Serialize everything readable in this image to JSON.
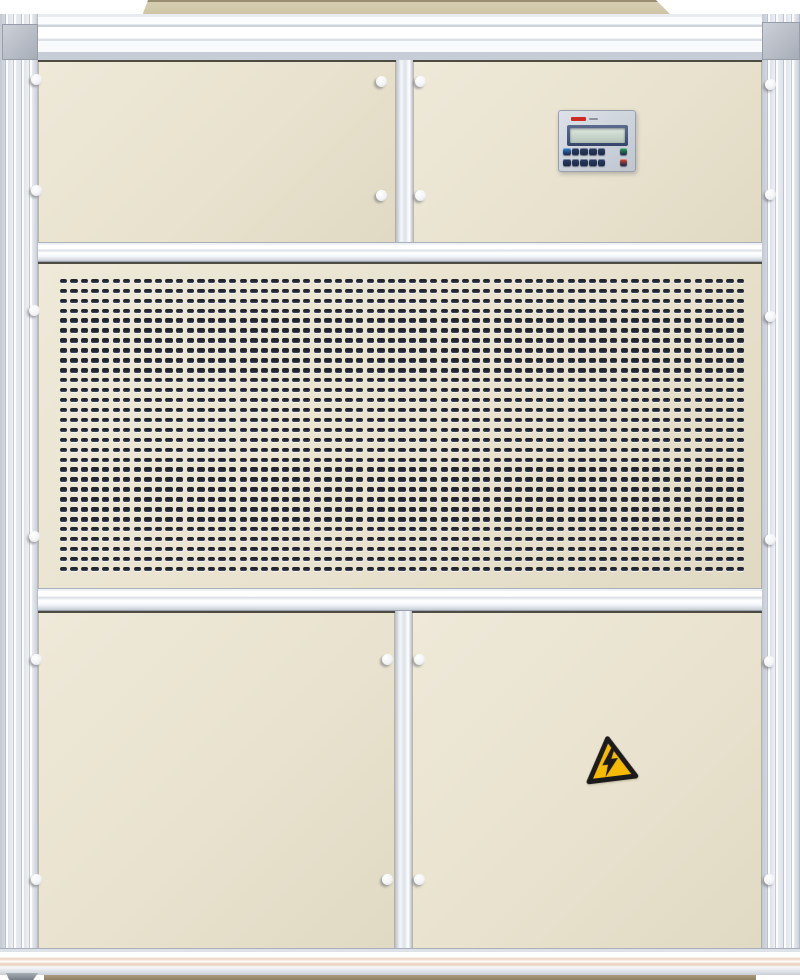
{
  "scene": {
    "subject": "industrial air handling unit cabinet, front view photograph",
    "background_color": "#ffffff"
  },
  "cabinet": {
    "panel_color": "#e8e2ce",
    "frame_color": "#e9edf2",
    "top_cap_color": "#d7ceb1",
    "base_color": "#ab9c7d",
    "fastener_knob_color": "#f3f4f6",
    "fastener_count": 20
  },
  "grille": {
    "rows": 30,
    "cols": 65,
    "slot_color": "#22242c"
  },
  "controller": {
    "body_color": "#ccd2da",
    "brand_mark_color": "#cf2b25",
    "lcd_bezel_color": "#46587c",
    "lcd_screen_color": "#c9d6cc",
    "keypad": {
      "row1": [
        "#2f7fd1",
        "#2c3d63",
        "#2c3d63",
        "#2c3d63",
        "#2c3d63",
        "#2aa05a"
      ],
      "row2": [
        "#2c3d63",
        "#2c3d63",
        "#2c3d63",
        "#2c3d63",
        "#2c3d63",
        "#d9472b"
      ]
    }
  },
  "warning_sticker": {
    "icon": "lightning-bolt-icon",
    "fill_color": "#f6ba00",
    "border_color": "#1b1b1b",
    "rotation_deg": -7
  }
}
